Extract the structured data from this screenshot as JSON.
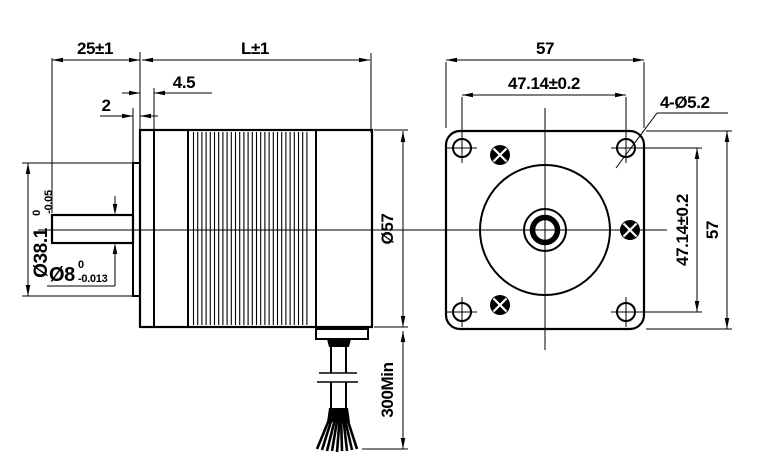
{
  "drawing": {
    "side_view": {
      "shaft_extension": "25±1",
      "body_length": "L±1",
      "front_plate_depth": "4.5",
      "boss_height": "2",
      "boss_diameter": "Ø38.1",
      "boss_diameter_tol_upper": "0",
      "boss_diameter_tol_lower": "-0.05",
      "shaft_diameter": "Ø8",
      "shaft_diameter_tol_upper": "0",
      "shaft_diameter_tol_lower": "-0.013",
      "body_diameter": "Ø57",
      "lead_length": "300Min"
    },
    "front_view": {
      "frame_width": "57",
      "hole_spacing_horizontal": "47.14±0.2",
      "mounting_holes_callout": "4-Ø5.2",
      "hole_spacing_vertical": "47.14±0.2",
      "frame_height": "57"
    },
    "colors": {
      "line": "#000000",
      "background": "#ffffff"
    }
  }
}
